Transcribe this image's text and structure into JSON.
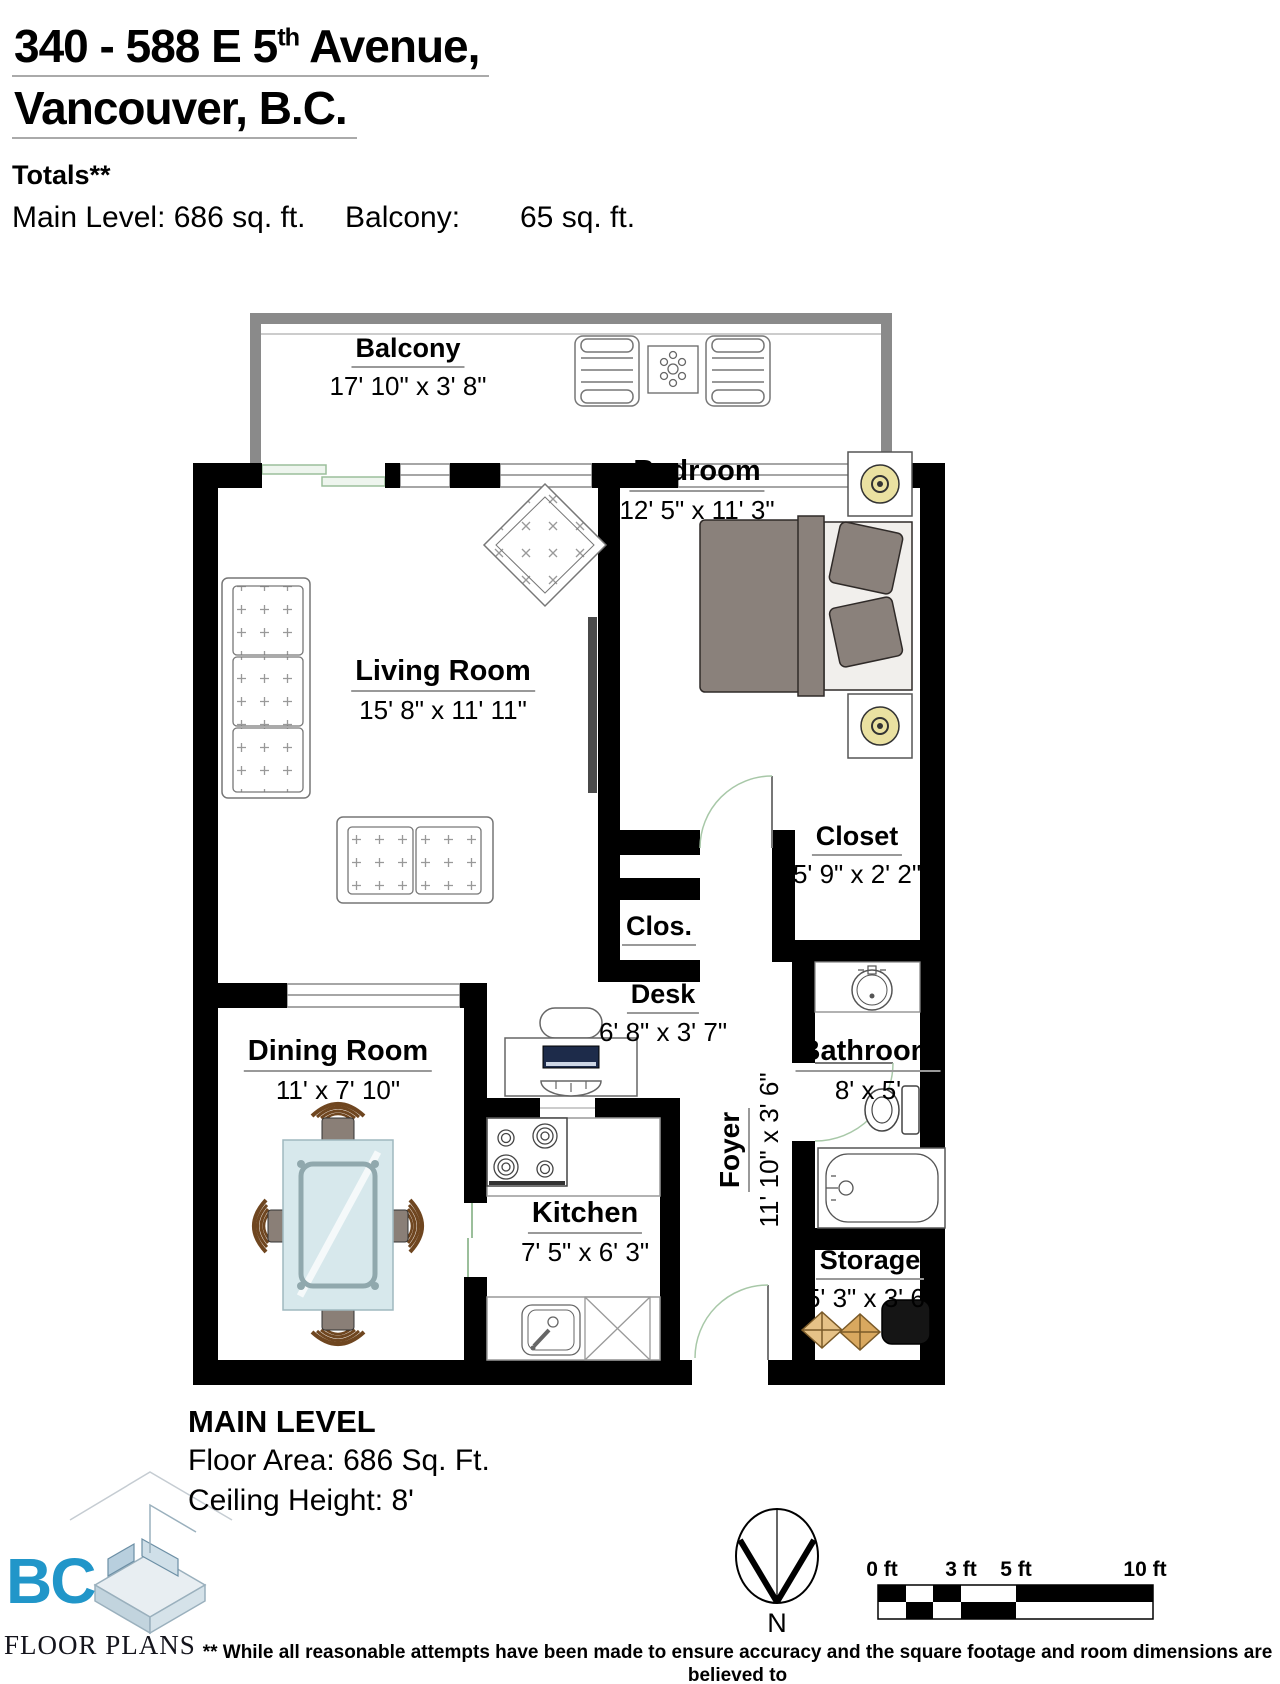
{
  "header": {
    "title_line1_pre": "340 - 588 E 5",
    "title_line1_sup": "th",
    "title_line1_post": " Avenue,",
    "title_line2": "Vancouver, B.C.",
    "totals_heading": "Totals**",
    "main_level_area": "Main Level: 686 sq. ft.",
    "balcony_label": "Balcony:",
    "balcony_area": "65 sq. ft."
  },
  "rooms": {
    "balcony": {
      "name": "Balcony",
      "dims": "17' 10\" x 3' 8\""
    },
    "bedroom": {
      "name": "Bedroom",
      "dims": "12' 5\" x 11' 3\""
    },
    "living_room": {
      "name": "Living Room",
      "dims": "15' 8\" x 11' 11\""
    },
    "clos": {
      "name": "Clos."
    },
    "closet": {
      "name": "Closet",
      "dims": "5' 9\" x 2' 2\""
    },
    "desk": {
      "name": "Desk",
      "dims": "6' 8\" x 3' 7\""
    },
    "dining_room": {
      "name": "Dining Room",
      "dims": "11' x 7' 10\""
    },
    "kitchen": {
      "name": "Kitchen",
      "dims": "7' 5\" x 6' 3\""
    },
    "foyer": {
      "name": "Foyer",
      "dims": "11' 10\" x 3' 6\""
    },
    "bathroom": {
      "name": "Bathroom",
      "dims": "8' x 5'"
    },
    "storage": {
      "name": "Storage",
      "dims": "5' 3\" x 3' 6\""
    }
  },
  "level_info": {
    "title": "MAIN LEVEL",
    "floor_area": "Floor Area: 686 Sq. Ft.",
    "ceiling_height": "Ceiling Height: 8'"
  },
  "compass": {
    "label": "N"
  },
  "scale_bar": {
    "labels": [
      "0 ft",
      "3 ft",
      "5 ft",
      "10 ft"
    ]
  },
  "logo": {
    "name": "BC",
    "subtitle": "FLOOR PLANS"
  },
  "disclaimer": {
    "line1": "** While all reasonable attempts have been made to ensure accuracy and the square footage and room dimensions are believed to",
    "line2": "be correct to ANSI Standards, due to the possibility of human error the information cannot be guaranteed. E&O Insured for $1,000,000"
  },
  "colors": {
    "wall": "#000000",
    "balcony_wall": "#8a8a8a",
    "window_line": "#888888",
    "door_arc": "#a8c8a8",
    "logo_blue": "#2196c9",
    "lamp_yellow": "#eae1a1",
    "bed_gray": "#8a817b",
    "glass_blue": "#d7e8ec",
    "chair_wood": "#6f4620",
    "box_tan": "#e3bc7f"
  }
}
